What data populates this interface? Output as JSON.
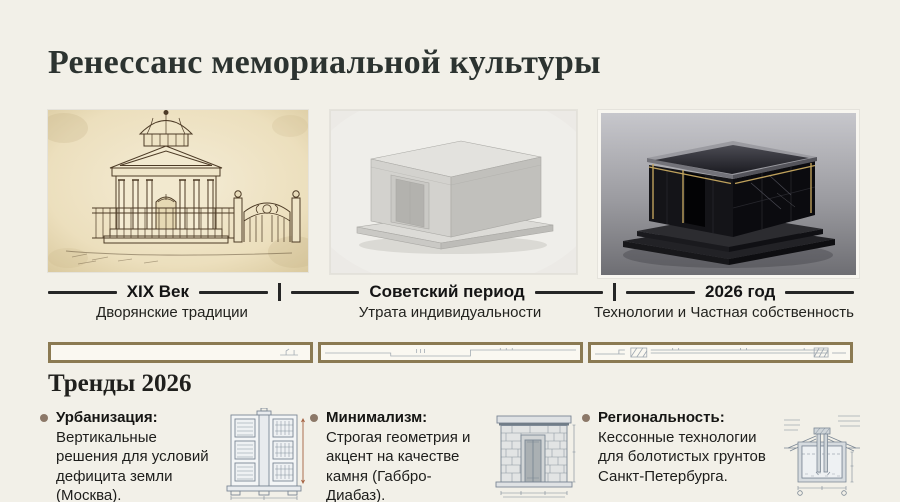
{
  "title": "Ренессанс мемориальной культуры",
  "timeline": {
    "eras": [
      {
        "label": "XIX Век",
        "sublabel": "Дворянские традиции",
        "image": "sepia-classical-mausoleum-drawing"
      },
      {
        "label": "Советский период",
        "sublabel": "Утрата индивидуальности",
        "image": "soviet-concrete-tomb-render"
      },
      {
        "label": "2026 год",
        "sublabel": "Технологии и Частная собственность",
        "image": "black-granite-smart-mausoleum-photo"
      }
    ]
  },
  "divider_strip": {
    "description": "architectural-section-band",
    "border_color": "#8b7a52"
  },
  "trends": {
    "heading": "Тренды 2026",
    "items": [
      {
        "label": "Урбанизация:",
        "text": "Вертикальные решения для условий дефицита земли (Москва).",
        "icon": "columbarium-elevation-drawing"
      },
      {
        "label": "Минимализм:",
        "text": "Строгая геометрия и акцент на качестве камня (Габбро-Диабаз).",
        "icon": "stone-mausoleum-facade-drawing"
      },
      {
        "label": "Региональность:",
        "text": "Кессонные технологии для болотистых грунтов Санкт-Петербурга.",
        "icon": "caisson-foundation-section-drawing"
      }
    ]
  },
  "colors": {
    "background": "#f2f0e8",
    "title_text": "#2c3330",
    "timeline_line": "#262626",
    "strip_border": "#8b7a52",
    "bullet": "#8c7868",
    "body_text": "#1d1d1b",
    "drawing_stroke": "#7b8794",
    "dimension_accent": "#a4603f",
    "gold_trim": "#c8a960"
  }
}
